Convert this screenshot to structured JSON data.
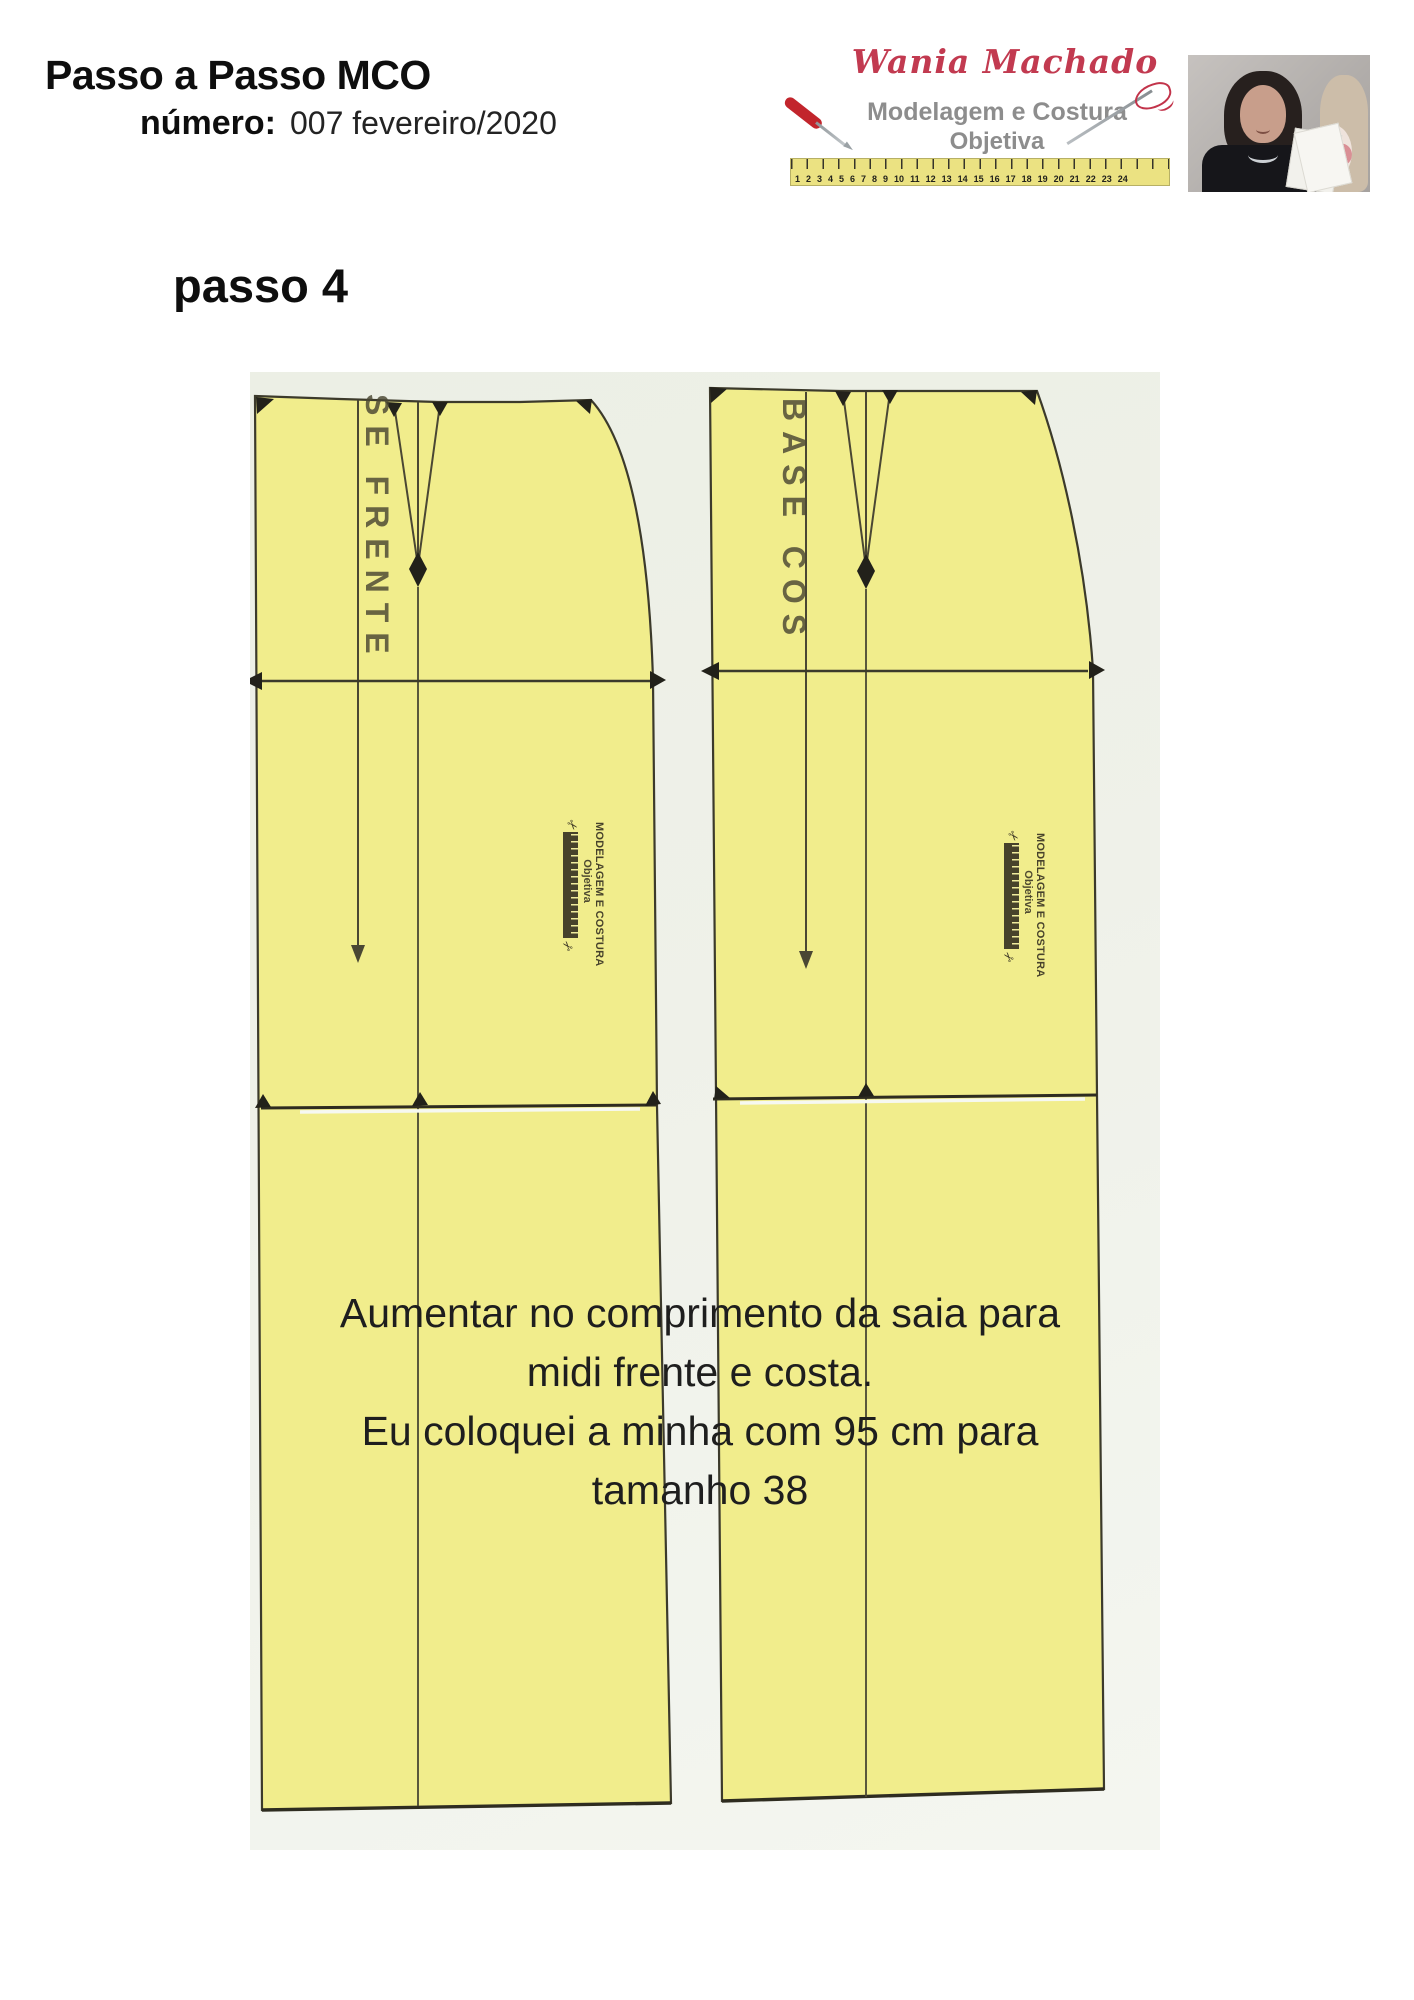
{
  "header": {
    "title": "Passo a Passo MCO",
    "numero_label": "número:",
    "numero_value": "007 fevereiro/2020",
    "logo": {
      "name": "Wania Machado",
      "line1": "Modelagem e Costura",
      "line2": "Objetiva",
      "ruler_numbers": "1 2 3 4 5 6 7 8 9 10 11 12 13 14 15 16 17 18 19 20 21 22 23 24"
    }
  },
  "step": {
    "title": "passo 4"
  },
  "patterns": {
    "left_label": "SE FRENTE",
    "right_label": "BASE COS",
    "stamp_line1": "MODELAGEM E COSTURA",
    "stamp_line2": "Objetiva",
    "scissors_glyph": "✂"
  },
  "note": {
    "line1": "Aumentar no comprimento da saia para",
    "line2": "midi frente e costa.",
    "line3": "Eu coloquei a minha com 95 cm para",
    "line4": "tamanho 38"
  },
  "colors": {
    "pattern_yellow": "#f1ed8c",
    "pattern_line": "#3c3a2b",
    "scan_background": "#edefe6",
    "brand_red": "#c23a50",
    "brand_gray": "#8d8d8d",
    "ruler_yellow": "#ebe282",
    "text_dark": "#1e1e1e"
  }
}
